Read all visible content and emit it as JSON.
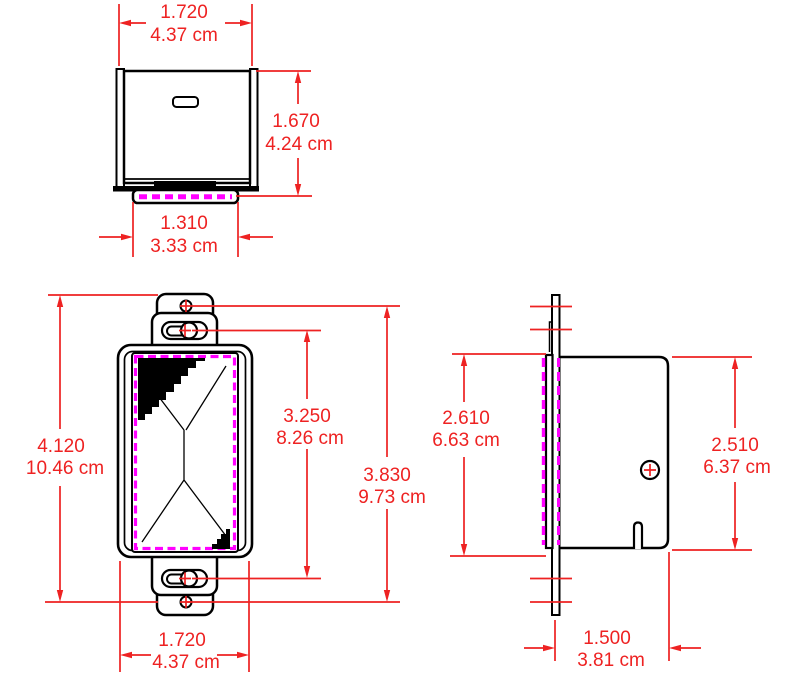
{
  "drawing": {
    "colors": {
      "dimension": "#ee2222",
      "gasket": "#ff00ff",
      "outline": "#000000",
      "background": "#ffffff"
    },
    "views": {
      "top": {
        "width": {
          "in": "1.720",
          "cm": "4.37 cm"
        },
        "height": {
          "in": "1.670",
          "cm": "4.24 cm"
        },
        "lip_width": {
          "in": "1.310",
          "cm": "3.33 cm"
        }
      },
      "front": {
        "height": {
          "in": "4.120",
          "cm": "10.46 cm"
        },
        "slot_span": {
          "in": "3.250",
          "cm": "8.26 cm"
        },
        "hole_span": {
          "in": "3.830",
          "cm": "9.73 cm"
        },
        "width": {
          "in": "1.720",
          "cm": "4.37 cm"
        }
      },
      "side": {
        "flange_height": {
          "in": "2.610",
          "cm": "6.63 cm"
        },
        "body_height": {
          "in": "2.510",
          "cm": "6.37 cm"
        },
        "depth": {
          "in": "1.500",
          "cm": "3.81 cm"
        }
      }
    }
  }
}
